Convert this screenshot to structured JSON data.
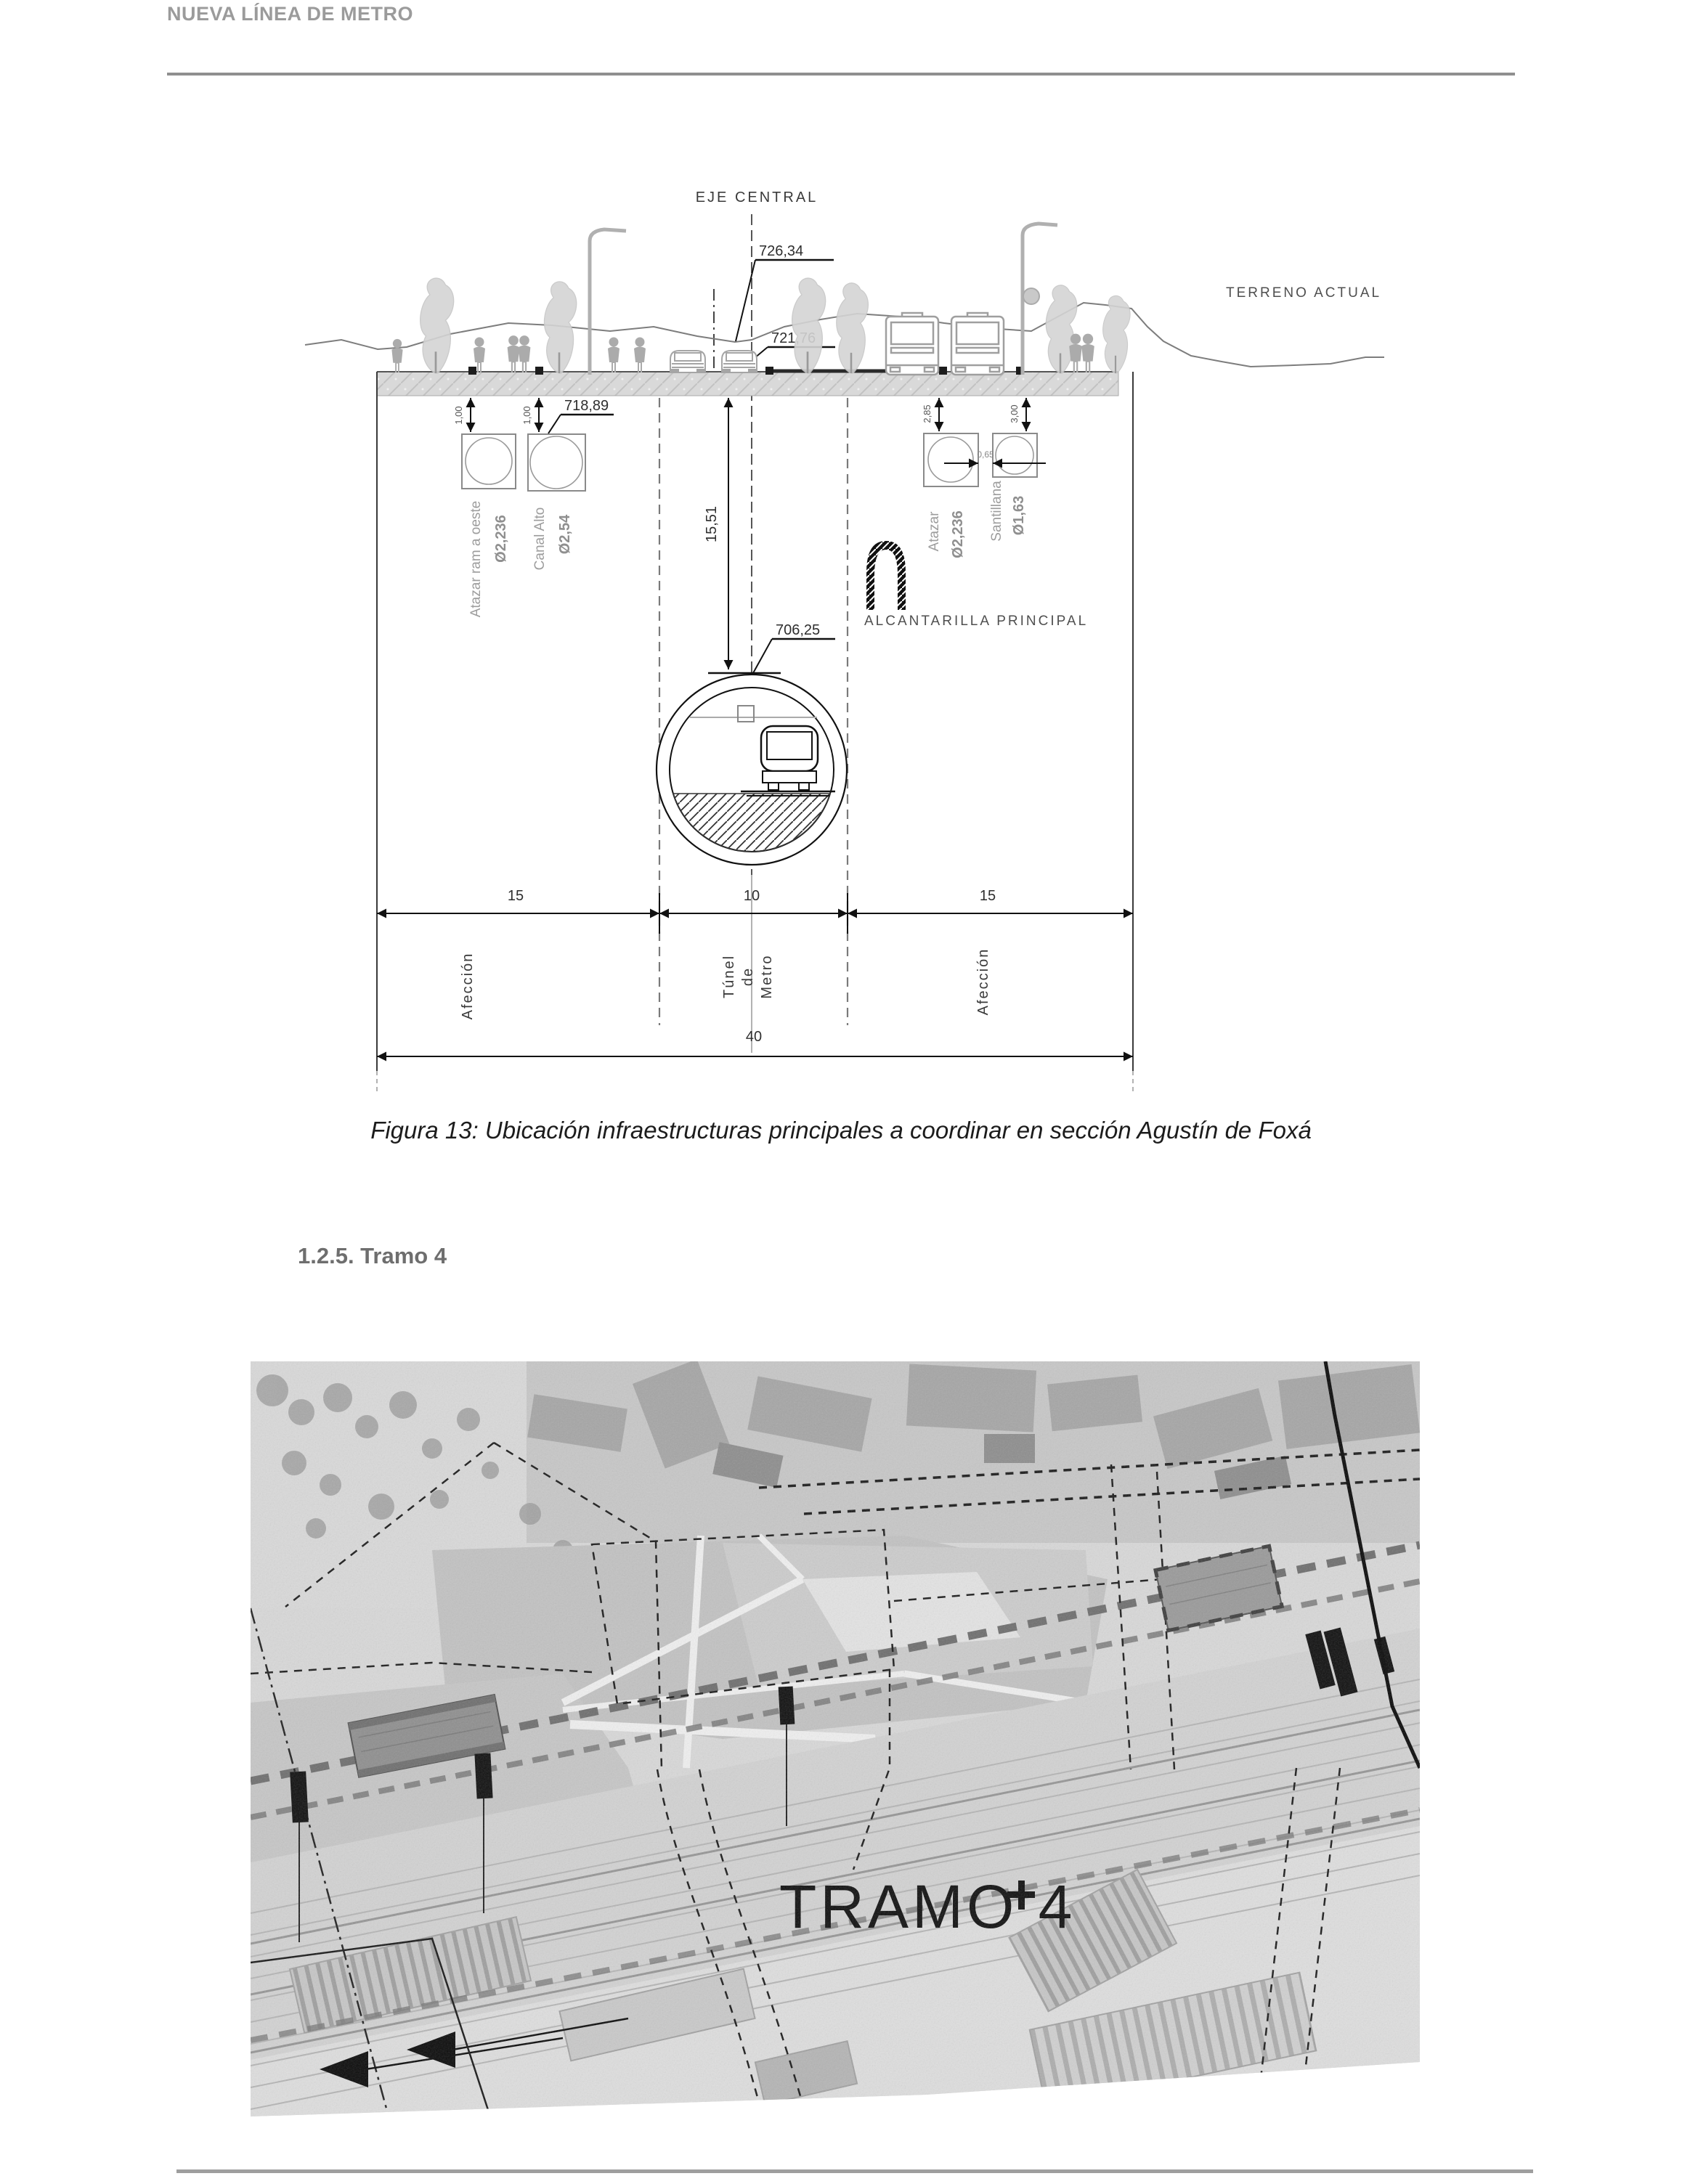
{
  "header": {
    "title": "NUEVA LÍNEA DE METRO"
  },
  "figure": {
    "caption": "Figura 13: Ubicación infraestructuras principales a coordinar en sección Agustín de Foxá",
    "diagram": {
      "axis_label": "EJE CENTRAL",
      "terrain_label": "TERRENO ACTUAL",
      "sewer_label": "ALCANTARILLA PRINCIPAL",
      "elevations": {
        "axis_top": "726,34",
        "street": "721,76",
        "pipes": "718,89",
        "tunnel_crown": "706,25"
      },
      "depth_to_crown": "15,51",
      "pipes": {
        "left": [
          {
            "name": "Atazar ram a oeste",
            "diameter": "Ø2,236",
            "cover": "1,00"
          },
          {
            "name": "Canal Alto",
            "diameter": "Ø2,54",
            "cover": "1,00"
          }
        ],
        "right": [
          {
            "name": "Atazar",
            "diameter": "Ø2,236",
            "cover": "2,85"
          },
          {
            "name": "Santillana",
            "diameter": "Ø1,63",
            "cover": "3,00"
          }
        ],
        "right_gap": "0,65"
      },
      "widths": {
        "left_affection": "15",
        "tunnel": "10",
        "right_affection": "15",
        "total": "40"
      },
      "zones": {
        "left": "Afección",
        "tunnel": [
          "Túnel",
          "de",
          "Metro"
        ],
        "right": "Afección"
      }
    }
  },
  "section": {
    "heading": "1.2.5. Tramo 4"
  },
  "map": {
    "label": "TRAMO 4"
  },
  "colors": {
    "ink": "#1a1a1a",
    "muted_gray": "#9b9b9b"
  }
}
